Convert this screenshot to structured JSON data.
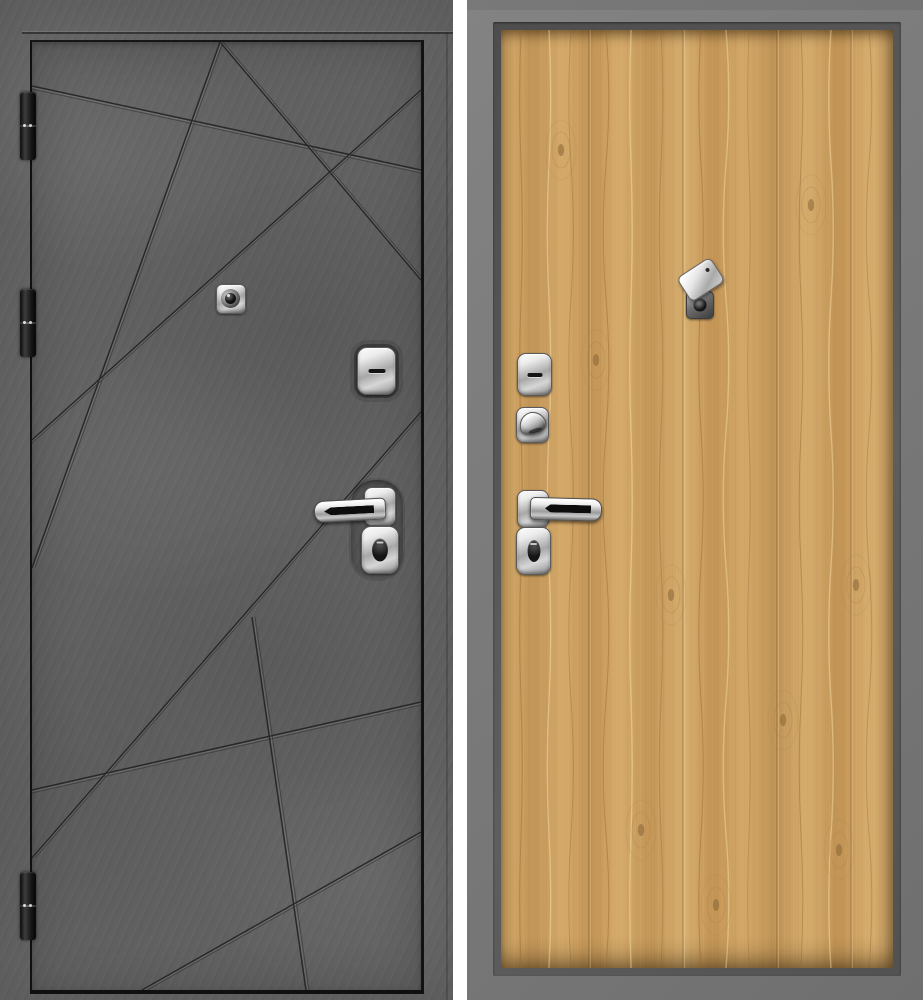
{
  "scene": {
    "type": "product-photo",
    "subject": "steel entry door shown from both sides: exterior concrete-finish leaf with diagonal milled grooves, interior light-oak panel in a gray metal frame",
    "canvas": {
      "width": 923,
      "height": 1000,
      "background": "#ffffff"
    }
  },
  "palette": {
    "concrete_base": "#646464",
    "gap_dark": "#121212",
    "groove_dark": "#232323",
    "hinge_dark": "#1c1c1c",
    "chrome_light": "#f6f6f6",
    "chrome_dark": "#757575",
    "black_insert": "#0d0d0d",
    "frame_gray": "#7b7b7b",
    "frame_lip_dark": "#525252",
    "oak_light": "#ddb377",
    "oak_base": "#cb9c5b",
    "oak_grain": "#a87d43",
    "oak_deep": "#826032",
    "divider_white": "#ffffff"
  },
  "left_door": {
    "name": "exterior-side-concrete",
    "panel_rect": [
      0,
      0,
      453,
      1000
    ],
    "leaf_rect": [
      30,
      40,
      389,
      948
    ],
    "hinges": [
      [
        20,
        92,
        16,
        68
      ],
      [
        20,
        289,
        16,
        68
      ],
      [
        20,
        872,
        16,
        68
      ]
    ],
    "grooves": [
      [
        0,
        44,
        389,
        128
      ],
      [
        188,
        0,
        389,
        238
      ],
      [
        188,
        0,
        0,
        526
      ],
      [
        0,
        398,
        389,
        48
      ],
      [
        0,
        748,
        389,
        660
      ],
      [
        389,
        370,
        0,
        816
      ],
      [
        220,
        575,
        274,
        948
      ],
      [
        110,
        948,
        389,
        790
      ]
    ],
    "peephole_rect": [
      216,
      284,
      28,
      28
    ],
    "deadbolt_plate_rect": [
      357,
      347,
      37,
      46
    ],
    "handle_recess_rect": [
      351,
      480,
      52,
      99
    ],
    "handle_rose_rect": [
      364,
      487,
      30,
      37
    ],
    "lever_rect": [
      314,
      498,
      70,
      20
    ],
    "cylinder_plate_rect": [
      361,
      526,
      36,
      46
    ]
  },
  "right_door": {
    "name": "interior-side-oak",
    "panel_rect": [
      467,
      0,
      456,
      1000
    ],
    "frame_lip_rect": [
      493,
      22,
      408,
      954
    ],
    "wood_rect": [
      501,
      30,
      392,
      938
    ],
    "plank_lines_x": [
      88,
      182,
      276,
      350
    ],
    "grain_streaks_x": [
      20,
      48,
      70,
      105,
      130,
      160,
      200,
      225,
      248,
      300,
      330,
      368
    ],
    "knots": [
      [
        95,
        330
      ],
      [
        170,
        565
      ],
      [
        140,
        800
      ],
      [
        282,
        690
      ],
      [
        310,
        175
      ],
      [
        355,
        555
      ],
      [
        215,
        875
      ],
      [
        60,
        120
      ],
      [
        338,
        820
      ]
    ],
    "peephole_base_rect": [
      686,
      291,
      26,
      26
    ],
    "peephole_cover_rect": [
      687,
      270,
      38,
      27
    ],
    "deadbolt_plate_rect": [
      517,
      353,
      33,
      41
    ],
    "thumbturn_rose_rect": [
      516,
      407,
      31,
      34
    ],
    "thumbturn_knob_rect": [
      519,
      412,
      25,
      21
    ],
    "handle_rose_rect": [
      517,
      490,
      30,
      36
    ],
    "lever_rect": [
      530,
      497,
      70,
      21
    ],
    "cylinder_plate_rect": [
      516,
      527,
      33,
      46
    ]
  }
}
